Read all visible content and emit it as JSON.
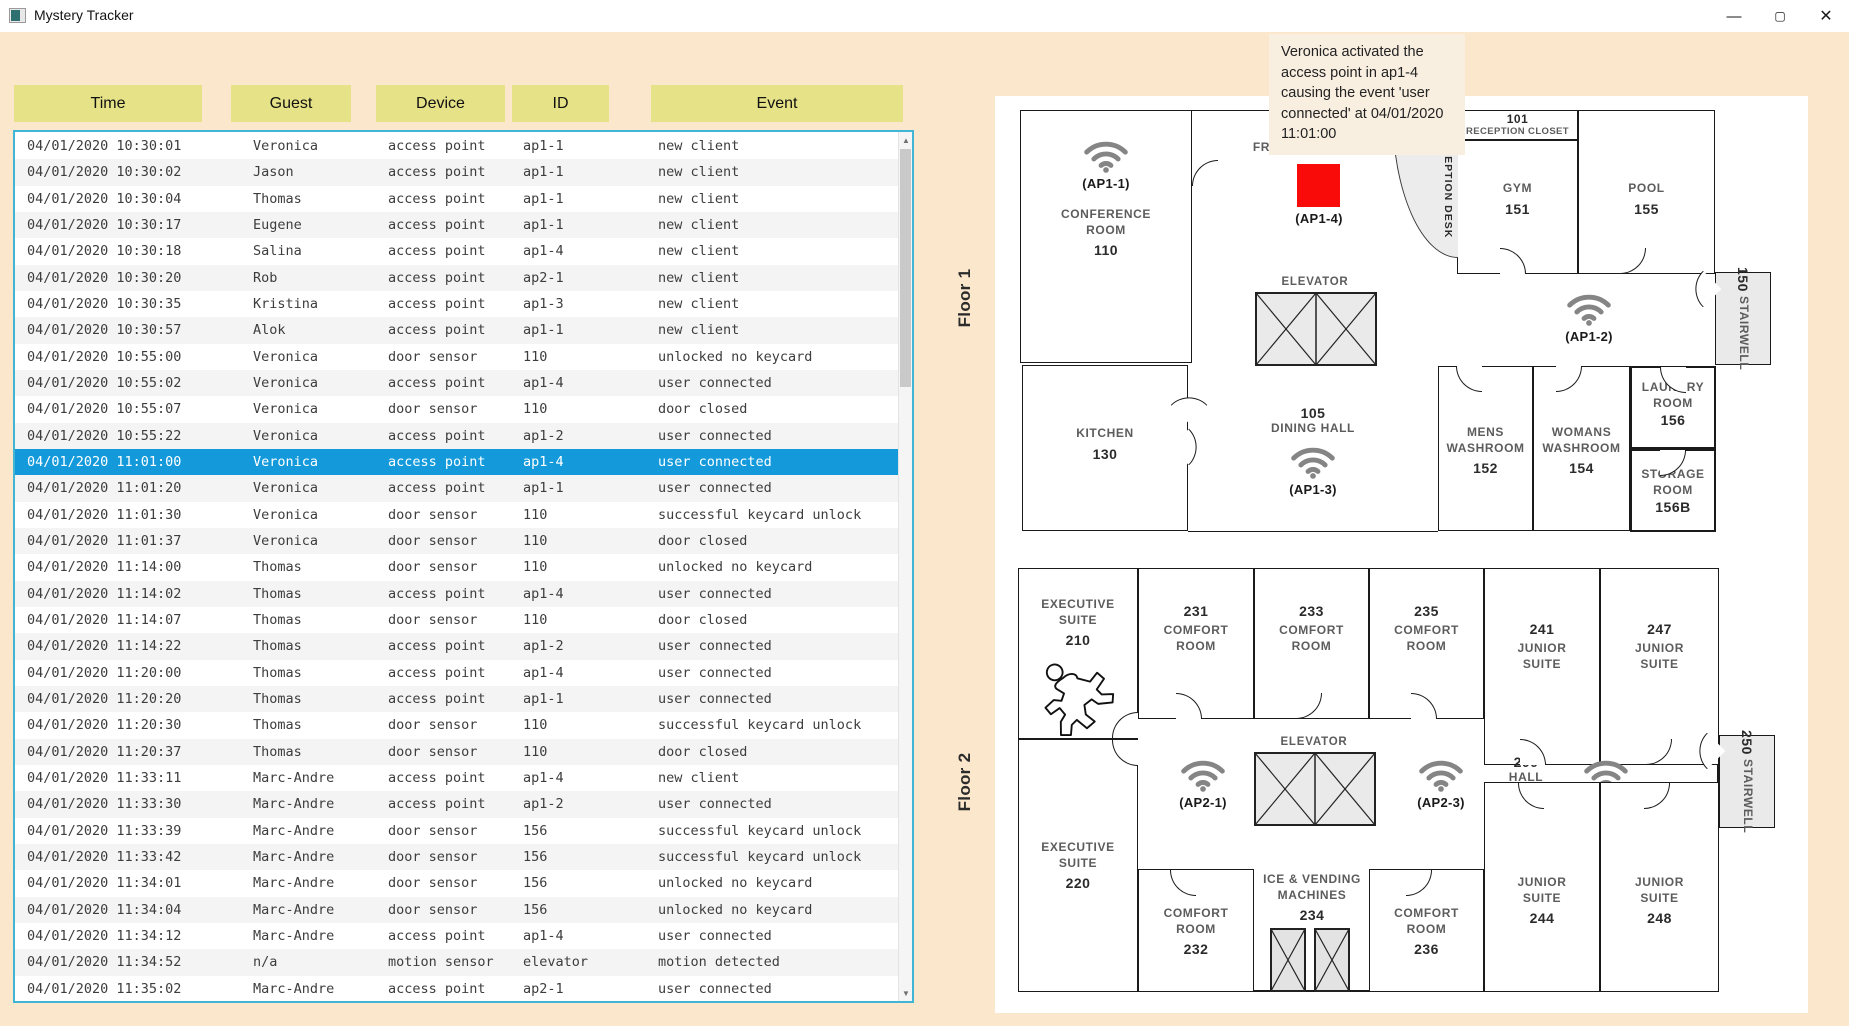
{
  "window": {
    "title": "Mystery Tracker",
    "minimize": "—",
    "maximize": "▢",
    "close": "✕"
  },
  "table": {
    "headers": [
      "Time",
      "Guest",
      "Device",
      "ID",
      "Event"
    ],
    "selected_row_index": 12,
    "rows": [
      {
        "time": "04/01/2020 10:30:01",
        "guest": "Veronica",
        "device": "access point",
        "id": "ap1-1",
        "event": "new client"
      },
      {
        "time": "04/01/2020 10:30:02",
        "guest": "Jason",
        "device": "access point",
        "id": "ap1-1",
        "event": "new client"
      },
      {
        "time": "04/01/2020 10:30:04",
        "guest": "Thomas",
        "device": "access point",
        "id": "ap1-1",
        "event": "new client"
      },
      {
        "time": "04/01/2020 10:30:17",
        "guest": "Eugene",
        "device": "access point",
        "id": "ap1-1",
        "event": "new client"
      },
      {
        "time": "04/01/2020 10:30:18",
        "guest": "Salina",
        "device": "access point",
        "id": "ap1-4",
        "event": "new client"
      },
      {
        "time": "04/01/2020 10:30:20",
        "guest": "Rob",
        "device": "access point",
        "id": "ap2-1",
        "event": "new client"
      },
      {
        "time": "04/01/2020 10:30:35",
        "guest": "Kristina",
        "device": "access point",
        "id": "ap1-3",
        "event": "new client"
      },
      {
        "time": "04/01/2020 10:30:57",
        "guest": "Alok",
        "device": "access point",
        "id": "ap1-1",
        "event": "new client"
      },
      {
        "time": "04/01/2020 10:55:00",
        "guest": "Veronica",
        "device": "door sensor",
        "id": "110",
        "event": "unlocked no keycard"
      },
      {
        "time": "04/01/2020 10:55:02",
        "guest": "Veronica",
        "device": "access point",
        "id": "ap1-4",
        "event": "user connected"
      },
      {
        "time": "04/01/2020 10:55:07",
        "guest": "Veronica",
        "device": "door sensor",
        "id": "110",
        "event": "door closed"
      },
      {
        "time": "04/01/2020 10:55:22",
        "guest": "Veronica",
        "device": "access point",
        "id": "ap1-2",
        "event": "user connected"
      },
      {
        "time": "04/01/2020 11:01:00",
        "guest": "Veronica",
        "device": "access point",
        "id": "ap1-4",
        "event": "user connected"
      },
      {
        "time": "04/01/2020 11:01:20",
        "guest": "Veronica",
        "device": "access point",
        "id": "ap1-1",
        "event": "user connected"
      },
      {
        "time": "04/01/2020 11:01:30",
        "guest": "Veronica",
        "device": "door sensor",
        "id": "110",
        "event": "successful keycard unlock"
      },
      {
        "time": "04/01/2020 11:01:37",
        "guest": "Veronica",
        "device": "door sensor",
        "id": "110",
        "event": "door closed"
      },
      {
        "time": "04/01/2020 11:14:00",
        "guest": "Thomas",
        "device": "door sensor",
        "id": "110",
        "event": "unlocked no keycard"
      },
      {
        "time": "04/01/2020 11:14:02",
        "guest": "Thomas",
        "device": "access point",
        "id": "ap1-4",
        "event": "user connected"
      },
      {
        "time": "04/01/2020 11:14:07",
        "guest": "Thomas",
        "device": "door sensor",
        "id": "110",
        "event": "door closed"
      },
      {
        "time": "04/01/2020 11:14:22",
        "guest": "Thomas",
        "device": "access point",
        "id": "ap1-2",
        "event": "user connected"
      },
      {
        "time": "04/01/2020 11:20:00",
        "guest": "Thomas",
        "device": "access point",
        "id": "ap1-4",
        "event": "user connected"
      },
      {
        "time": "04/01/2020 11:20:20",
        "guest": "Thomas",
        "device": "access point",
        "id": "ap1-1",
        "event": "user connected"
      },
      {
        "time": "04/01/2020 11:20:30",
        "guest": "Thomas",
        "device": "door sensor",
        "id": "110",
        "event": "successful keycard unlock"
      },
      {
        "time": "04/01/2020 11:20:37",
        "guest": "Thomas",
        "device": "door sensor",
        "id": "110",
        "event": "door closed"
      },
      {
        "time": "04/01/2020 11:33:11",
        "guest": "Marc-Andre",
        "device": "access point",
        "id": "ap1-4",
        "event": "new client"
      },
      {
        "time": "04/01/2020 11:33:30",
        "guest": "Marc-Andre",
        "device": "access point",
        "id": "ap1-2",
        "event": "user connected"
      },
      {
        "time": "04/01/2020 11:33:39",
        "guest": "Marc-Andre",
        "device": "door sensor",
        "id": "156",
        "event": "successful keycard unlock"
      },
      {
        "time": "04/01/2020 11:33:42",
        "guest": "Marc-Andre",
        "device": "door sensor",
        "id": "156",
        "event": "successful keycard unlock"
      },
      {
        "time": "04/01/2020 11:34:01",
        "guest": "Marc-Andre",
        "device": "door sensor",
        "id": "156",
        "event": "unlocked no keycard"
      },
      {
        "time": "04/01/2020 11:34:04",
        "guest": "Marc-Andre",
        "device": "door sensor",
        "id": "156",
        "event": "unlocked no keycard"
      },
      {
        "time": "04/01/2020 11:34:12",
        "guest": "Marc-Andre",
        "device": "access point",
        "id": "ap1-4",
        "event": "user connected"
      },
      {
        "time": "04/01/2020 11:34:52",
        "guest": "n/a",
        "device": "motion sensor",
        "id": "elevator",
        "event": "motion detected"
      },
      {
        "time": "04/01/2020 11:35:02",
        "guest": "Marc-Andre",
        "device": "access point",
        "id": "ap2-1",
        "event": "user connected"
      }
    ]
  },
  "tooltip": {
    "text": "Veronica activated the access point in ap1-4 causing the event 'user connected' at 04/01/2020 11:01:00"
  },
  "floor1": {
    "label": "Floor 1",
    "conference": {
      "name": "CONFERENCE ROOM",
      "number": "110"
    },
    "lobby": {
      "name": "FRONT LOBBY"
    },
    "reception_desk": {
      "name": "RECEPTION DESK"
    },
    "closet": {
      "number": "101",
      "name": "RECEPTION CLOSET"
    },
    "gym": {
      "name": "GYM",
      "number": "151"
    },
    "pool": {
      "name": "POOL",
      "number": "155"
    },
    "stairwell": {
      "number": "150",
      "name": "STAIRWELL"
    },
    "elevator_label": "ELEVATOR",
    "kitchen": {
      "name": "KITCHEN",
      "number": "130"
    },
    "dining": {
      "number": "105",
      "name": "DINING HALL"
    },
    "mens": {
      "name": "MENS WASHROOM",
      "number": "152"
    },
    "womans": {
      "name": "WOMANS WASHROOM",
      "number": "154"
    },
    "laundry": {
      "name": "LAUNDRY ROOM",
      "number": "156"
    },
    "storage": {
      "name": "STORAGE ROOM",
      "number": "156B"
    },
    "ap1_1": "(AP1-1)",
    "ap1_2": "(AP1-2)",
    "ap1_3": "(AP1-3)",
    "ap1_4": "(AP1-4)"
  },
  "floor2": {
    "label": "Floor 2",
    "exec210": {
      "name": "EXECUTIVE SUITE",
      "number": "210"
    },
    "exec220": {
      "name": "EXECUTIVE SUITE",
      "number": "220"
    },
    "r231": {
      "number": "231",
      "name": "COMFORT ROOM"
    },
    "r233": {
      "number": "233",
      "name": "COMFORT ROOM"
    },
    "r235": {
      "number": "235",
      "name": "COMFORT ROOM"
    },
    "r241": {
      "number": "241",
      "name": "JUNIOR SUITE"
    },
    "r247": {
      "number": "247",
      "name": "JUNIOR SUITE"
    },
    "elevator_label": "ELEVATOR",
    "hall": {
      "number": "200",
      "name": "HALL"
    },
    "stairwell": {
      "number": "250",
      "name": "STAIRWELL"
    },
    "r232": {
      "name": "COMFORT ROOM",
      "number": "232"
    },
    "ice": {
      "name": "ICE & VENDING MACHINES",
      "number": "234"
    },
    "r236": {
      "name": "COMFORT ROOM",
      "number": "236"
    },
    "r244": {
      "name": "JUNIOR SUITE",
      "number": "244"
    },
    "r248": {
      "name": "JUNIOR SUITE",
      "number": "248"
    },
    "ap2_1": "(AP2-1)",
    "ap2_2": "(AP2-2)",
    "ap2_3": "(AP2-3)"
  },
  "colors": {
    "background": "#FBE7CB",
    "header_button": "#E5E287",
    "selected_row": "#149ADB",
    "table_border": "#41B5D6",
    "active_ap_marker": "#F90B09",
    "tooltip_background": "#F9EFE1"
  }
}
